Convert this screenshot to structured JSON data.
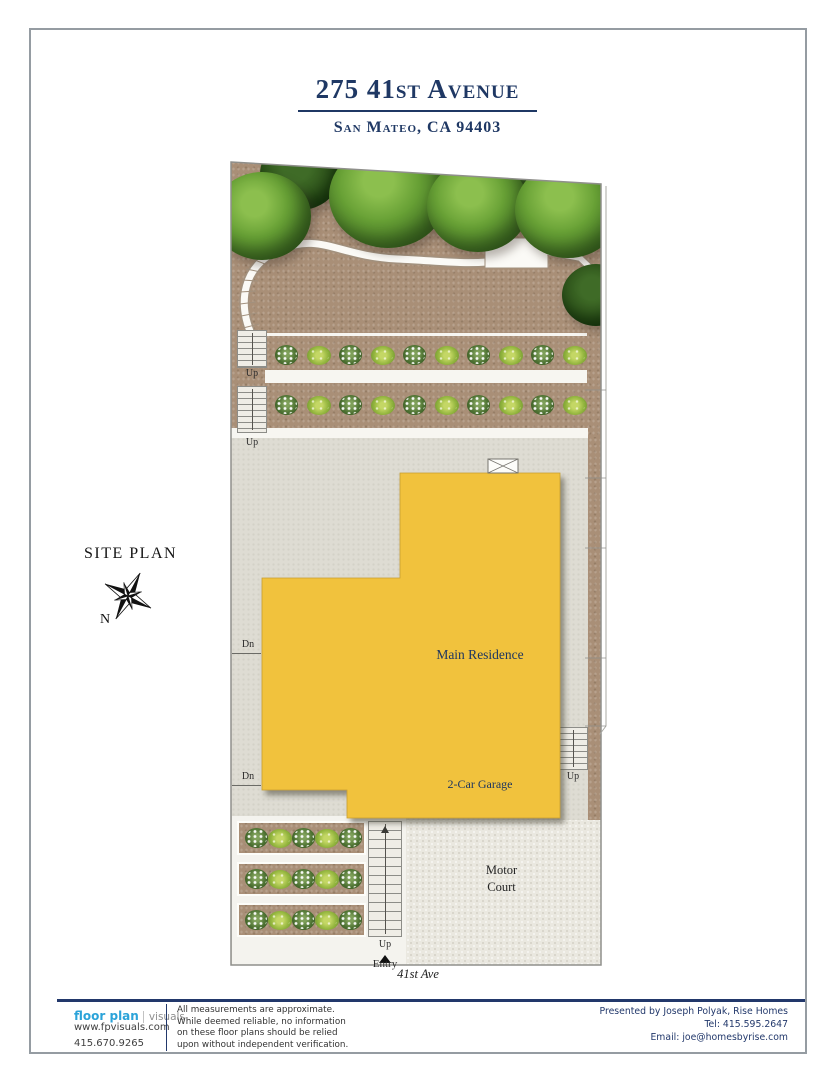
{
  "header": {
    "title": "275 41st Avenue",
    "subtitle": "San Mateo, CA 94403"
  },
  "plan": {
    "label": "SITE PLAN",
    "north_label": "N",
    "street_label": "41st Ave",
    "main_residence_label": "Main Residence",
    "garage_label": "2-Car Garage",
    "motor_court_line1": "Motor",
    "motor_court_line2": "Court",
    "up_label": "Up",
    "down_label": "Dn",
    "entry_label": "Entry"
  },
  "footer": {
    "logo_primary": "floor plan",
    "logo_secondary": "visuals",
    "website": "www.fpvisuals.com",
    "phone": "415.670.9265",
    "disclaimer_line1": "All measurements are approximate.",
    "disclaimer_line2": "While deemed reliable, no information",
    "disclaimer_line3": "on these floor plans should be relied",
    "disclaimer_line4": "upon without independent verification.",
    "presented_by": "Presented by Joseph Polyak, Rise Homes",
    "tel": "Tel: 415.595.2647",
    "email": "Email: joe@homesbyrise.com"
  },
  "colors": {
    "accent_navy": "#1f3864",
    "residence_yellow": "#f1c23d",
    "logo_blue": "#2ba3d9",
    "dirt_brown": "#a98f77",
    "tree_green": "#5d9331",
    "concrete_gray": "#dedcd3",
    "motor_court_gray": "#eae8e0"
  }
}
